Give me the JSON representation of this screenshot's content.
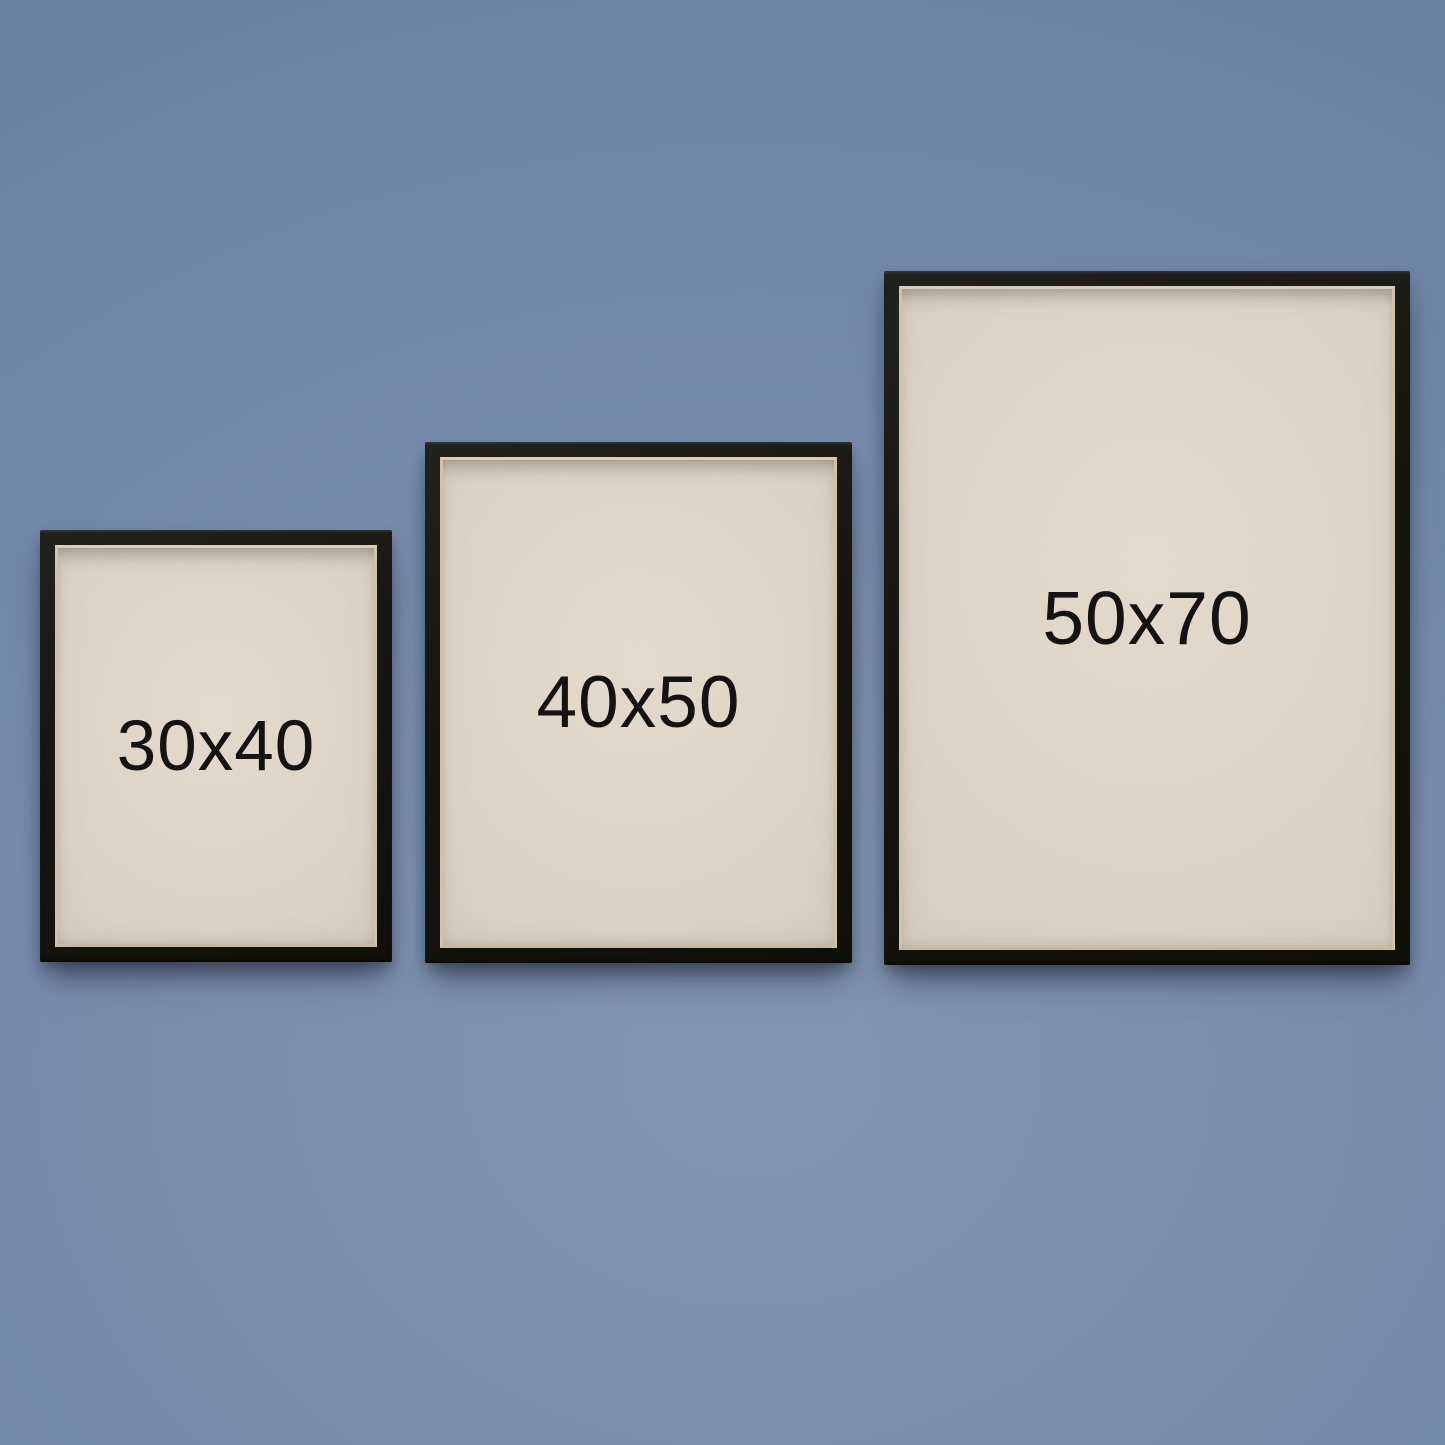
{
  "frames": [
    {
      "label": "30x40"
    },
    {
      "label": "40x50"
    },
    {
      "label": "50x70"
    }
  ],
  "colors": {
    "wall": "#7a8eab",
    "wall_top": "#6d83a4",
    "wall_light": "#8195b2",
    "frame_black": "#16150f",
    "mat_lip": "#cfc3ae",
    "paper": "#ddd4c6",
    "label_text": "#131313"
  }
}
